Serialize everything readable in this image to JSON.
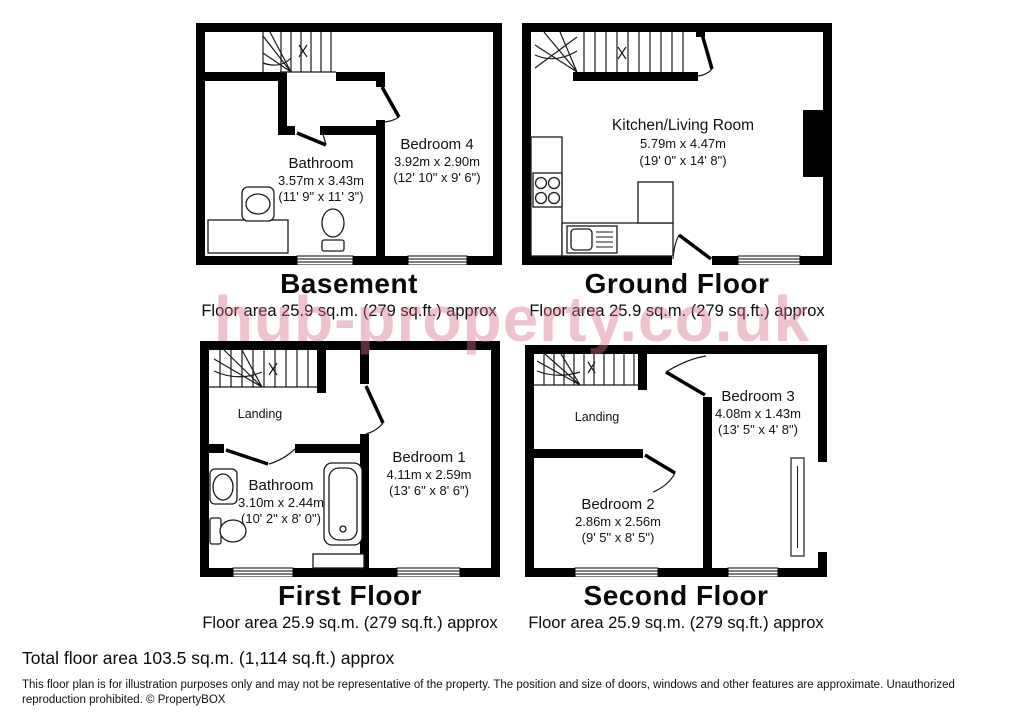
{
  "watermark": {
    "text": "hub-property.co.uk",
    "color": "#dc6e87"
  },
  "floors": {
    "basement": {
      "title": "Basement",
      "area": "Floor area 25.9 sq.m. (279 sq.ft.) approx",
      "rooms": {
        "bathroom": {
          "name": "Bathroom",
          "dim_m": "3.57m x 3.43m",
          "dim_ft": "(11' 9\" x 11' 3\")"
        },
        "bedroom4": {
          "name": "Bedroom 4",
          "dim_m": "3.92m x 2.90m",
          "dim_ft": "(12' 10\" x 9' 6\")"
        }
      }
    },
    "ground": {
      "title": "Ground Floor",
      "area": "Floor area 25.9 sq.m. (279 sq.ft.) approx",
      "rooms": {
        "kitchen": {
          "name": "Kitchen/Living Room",
          "dim_m": "5.79m x 4.47m",
          "dim_ft": "(19' 0\" x 14' 8\")"
        }
      }
    },
    "first": {
      "title": "First Floor",
      "area": "Floor area 25.9 sq.m. (279 sq.ft.) approx",
      "rooms": {
        "landing": {
          "name": "Landing"
        },
        "bathroom": {
          "name": "Bathroom",
          "dim_m": "3.10m x 2.44m",
          "dim_ft": "(10' 2\" x 8' 0\")"
        },
        "bedroom1": {
          "name": "Bedroom 1",
          "dim_m": "4.11m x 2.59m",
          "dim_ft": "(13' 6\" x 8' 6\")"
        }
      }
    },
    "second": {
      "title": "Second Floor",
      "area": "Floor area 25.9 sq.m. (279 sq.ft.) approx",
      "rooms": {
        "landing": {
          "name": "Landing"
        },
        "bedroom3": {
          "name": "Bedroom 3",
          "dim_m": "4.08m x 1.43m",
          "dim_ft": "(13' 5\" x 4' 8\")"
        },
        "bedroom2": {
          "name": "Bedroom 2",
          "dim_m": "2.86m x 2.56m",
          "dim_ft": "(9' 5\" x 8' 5\")"
        }
      }
    }
  },
  "footer": {
    "total": "Total floor area 103.5 sq.m. (1,114 sq.ft.) approx",
    "disclaimer": "This floor plan is for illustration purposes only and may not be representative of the property. The position and size of doors, windows and other features are approximate. Unauthorized reproduction prohibited. © PropertyBOX"
  },
  "colors": {
    "wall": "#000000"
  }
}
